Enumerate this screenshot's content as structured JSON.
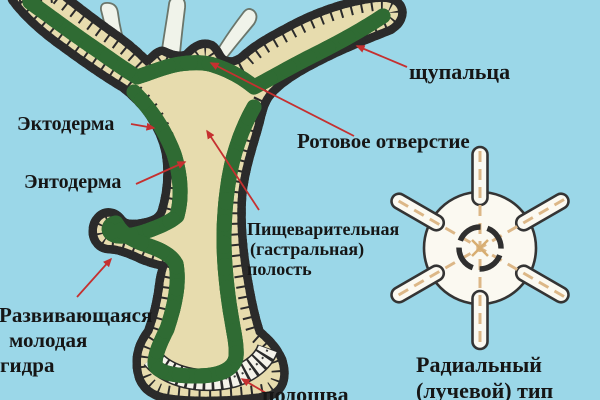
{
  "figure": {
    "title_hint": "Hydra longitudinal section with radial symmetry scheme",
    "background_color": "#9bd7e8",
    "palette": {
      "body_cavity": "#e7dcae",
      "ectoderm_cells": "#f5f3ea",
      "endoderm_cells": "#85c573",
      "cell_outline": "#2b2b2b",
      "tentacle_fill": "#f0f3ea",
      "radial_fill": "#fbf9f1",
      "radial_dash": "#dcb787",
      "arrow": "#c53030",
      "label_text": "#161616"
    }
  },
  "labels": {
    "tentacles": "щупальца",
    "ectoderm": "Эктодерма",
    "endoderm": "Энтодерма",
    "mouth": "Ротовое отверстие",
    "digestive_cavity": [
      "Пищеварительная",
      "(гастральная)",
      "полость"
    ],
    "developing_bud": [
      "Развивающаяся",
      "молодая",
      "гидра"
    ],
    "sole": "подошва",
    "radial_type": [
      "Радиальный",
      "(лучевой) тип"
    ]
  }
}
